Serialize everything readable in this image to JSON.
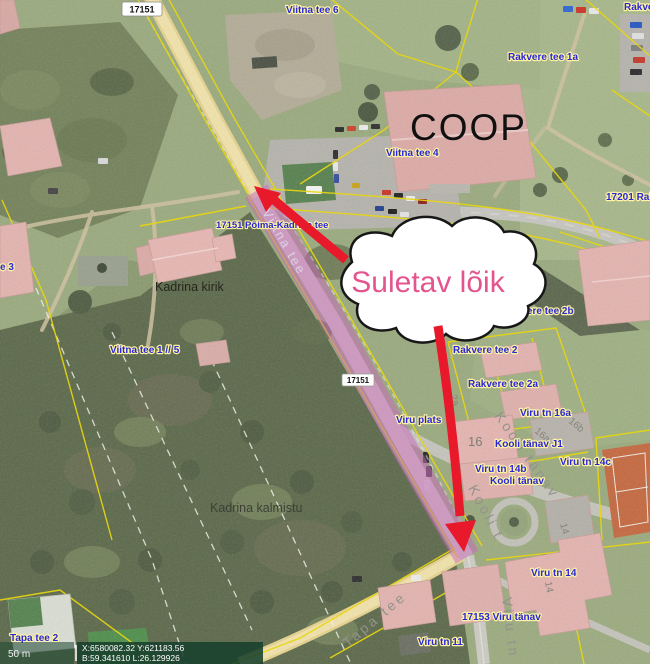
{
  "annotation": {
    "closed_section_label": "Suletav lõik"
  },
  "road_badges": {
    "top": "17151",
    "middle": "17151"
  },
  "address_labels": {
    "viitna_tee_6": "Viitna tee 6",
    "rakvere_top_right": "Rakvere",
    "rakvere_tee_1a": "Rakvere tee 1a",
    "viitna_tee_4": "Viitna tee 4",
    "road_17201": "17201 Rakv",
    "road_17151": "17151 Põima-Kadrina tee",
    "rakvere_tee_2b": "Rakvere tee 2b",
    "rakvere_tee_2": "Rakvere tee 2",
    "rakvere_tee_2a": "Rakvere tee 2a",
    "viru_tn_16a": "Viru tn 16a",
    "viru_plats": "Viru plats",
    "kooli_tanav_j1": "Kooli tänav J1",
    "viru_tn_14b": "Viru tn 14b",
    "kooli_tanav": "Kooli tänav",
    "viru_tn_14c": "Viru tn 14c",
    "viru_tn_14": "Viru tn 14",
    "road_17153": "17153 Viru tänav",
    "viru_tn_11": "Viru tn 11",
    "viitna_tee_1_5": "Viitna tee 1 // 5",
    "tee_3_partial": "e 3",
    "tapa_tee_2": "Tapa tee 2"
  },
  "place_labels": {
    "coop": "COOP",
    "kadrina_kirik": "Kadrina kirik",
    "kadrina_kalmistu": "Kadrina kalmistu"
  },
  "street_names": {
    "viitna_tee": "Viitna tee",
    "kooli_tanav": "Kooli tänav",
    "kooli_partial": "Kooli t",
    "tapa_tee": "Tapa tee",
    "viru_tn": "Viru tn"
  },
  "parcel_numbers": {
    "n16": "16",
    "n16a": "16a",
    "n16b": "16b",
    "n14": "14",
    "n14_school": "14",
    "n2": "2",
    "n2a": "2a"
  },
  "statusbar": {
    "scale_label": "50 m",
    "coord_xy": "X:6580082.32 Y:621183.56",
    "coord_bl": "B:59.341610 L:26.129926"
  },
  "colors": {
    "highlight_pink": "#c868be",
    "annotation_pink": "#e4548e",
    "arrow_red": "#e8192b",
    "cadastral_yellow": "#ecd800",
    "label_blue": "#2828d8"
  }
}
